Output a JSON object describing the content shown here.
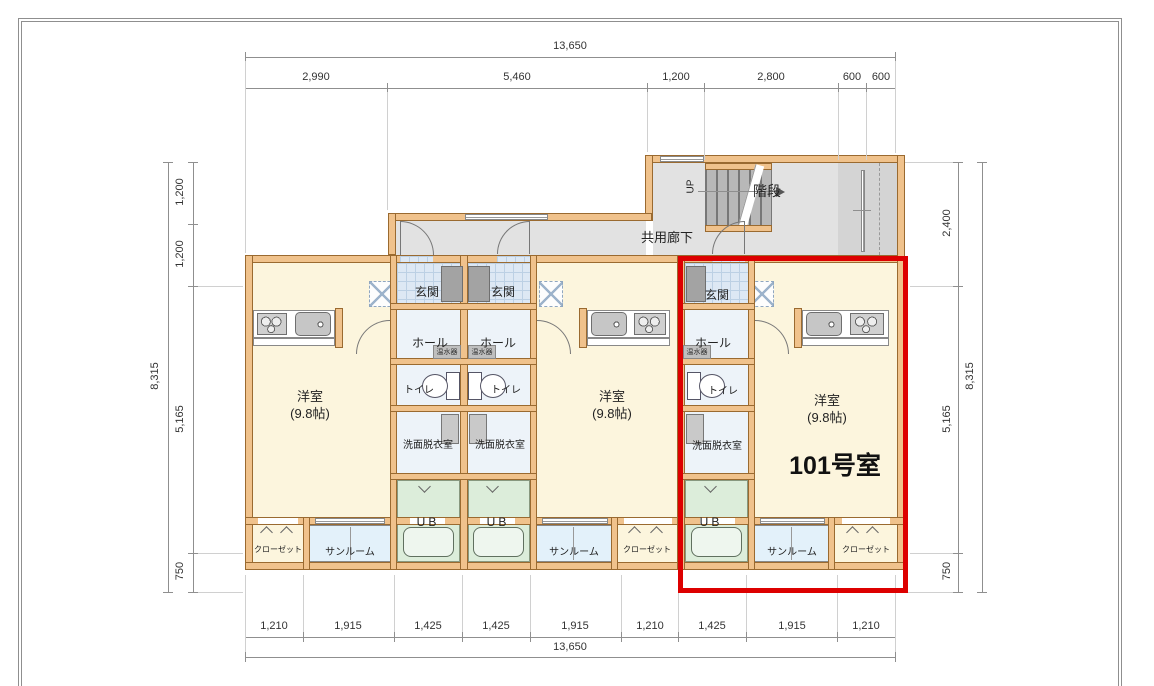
{
  "drawing": {
    "highlight_room": "101号室",
    "highlight_color": "#dd0000",
    "wall_color": "#f0c28c"
  },
  "dims": {
    "top_total": "13,650",
    "top": [
      "2,990",
      "5,460",
      "1,200",
      "2,800",
      "600",
      "600"
    ],
    "bottom": [
      "1,210",
      "1,915",
      "1,425",
      "1,425",
      "1,915",
      "1,210",
      "1,425",
      "1,915",
      "1,210"
    ],
    "bottom_total": "13,650",
    "left": [
      "1,200",
      "1,200",
      "5,165",
      "750"
    ],
    "left_total": "8,315",
    "right": [
      "2,400",
      "5,165",
      "750"
    ],
    "right_total": "8,315"
  },
  "labels": {
    "stairs": "階段",
    "up": "UP",
    "common_corridor": "共用廊下",
    "entrance": "玄関",
    "hall": "ホール",
    "water_heater": "温水器",
    "toilet": "トイレ",
    "washroom": "洗面脱衣室",
    "room": "洋室",
    "room_size": "(9.8帖)",
    "unit_bath": "UB",
    "sunroom": "サンルーム",
    "closet": "クローゼット"
  }
}
